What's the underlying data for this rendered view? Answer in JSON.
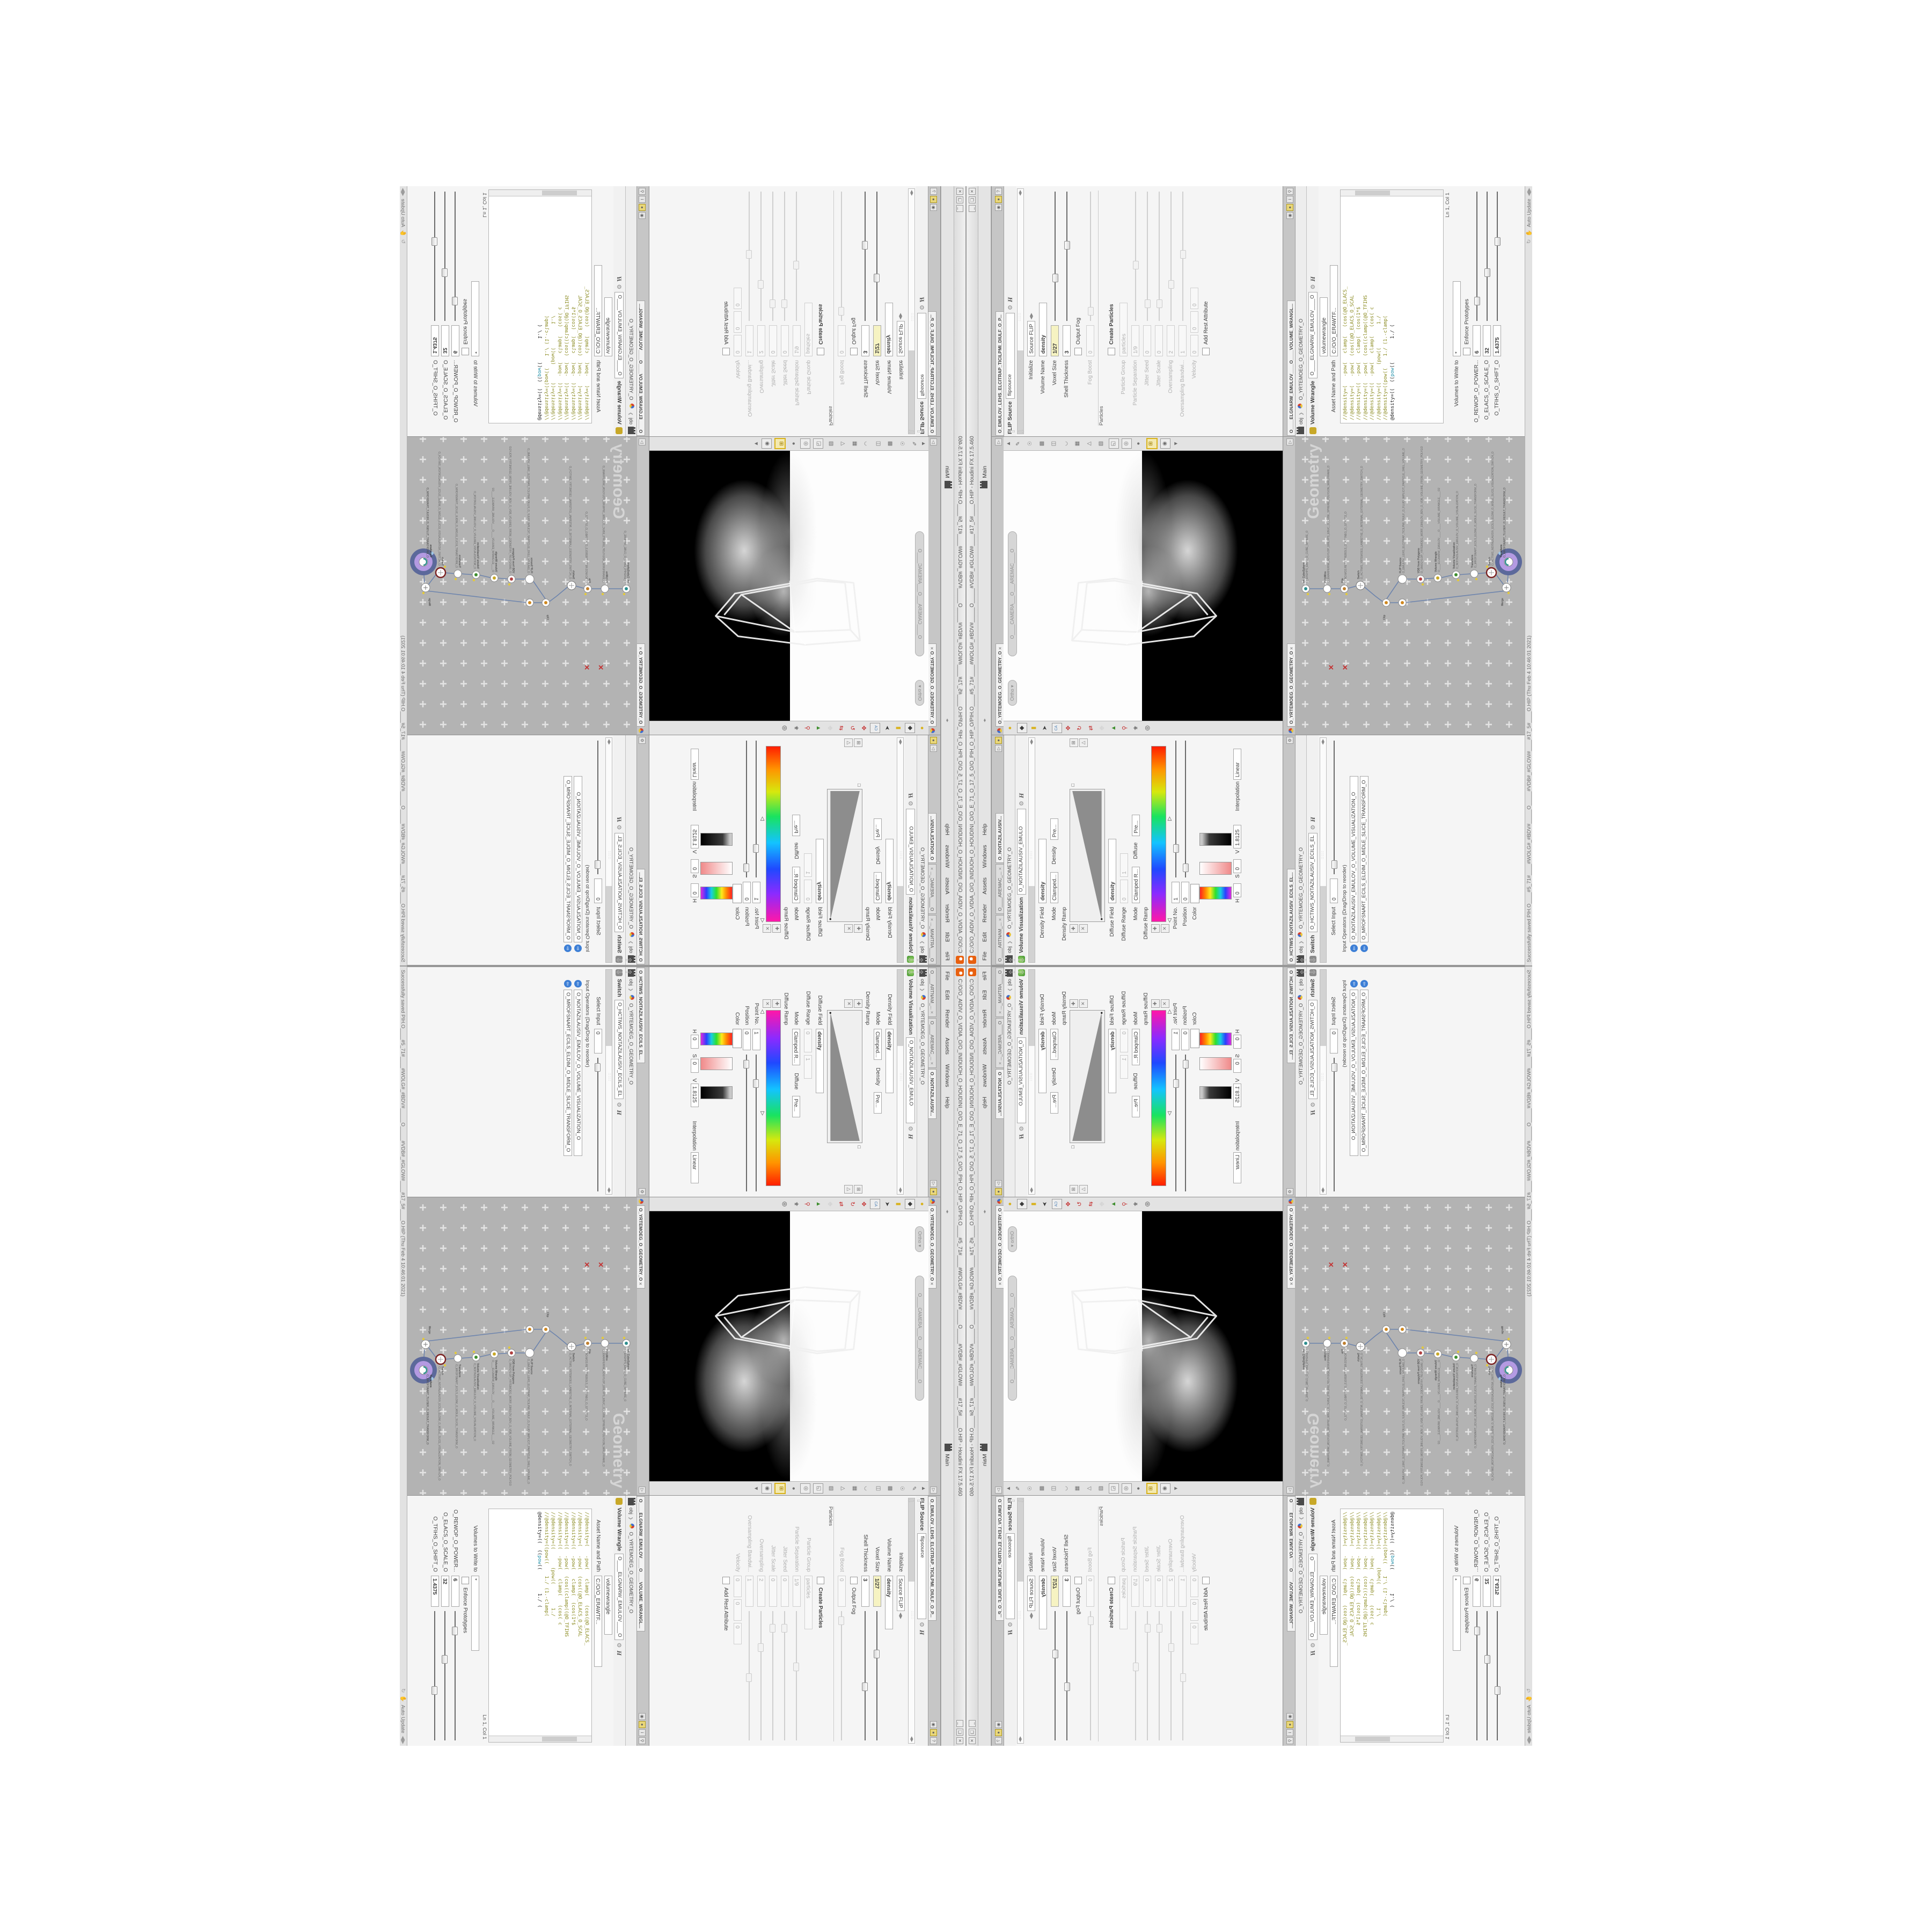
{
  "window": {
    "title": "C:/O/O_AIDIV_O_VIDIA_O/O_INIDUOH_O_HOUDINI_O/O_E_71_O_17_5_O/O_PIH_O_HIP_O/PIH.O____#5_71#____#WOLG#_#BDV#_____O_____#VDB#_#GLOW#____#17_5#____O.HIP - Houdini FX 17.5.460",
    "btn_min": "_",
    "btn_max": "❏",
    "btn_close": "✕"
  },
  "menu": {
    "items": [
      "File",
      "Edit",
      "Render",
      "Assets",
      "Windows",
      "Help"
    ],
    "desktop": "Main",
    "splitter": "◂▸"
  },
  "status": {
    "saved": "Successfully saved PIH.O____#5_71#____#WOLG#_#BDV#_____O_____#VDB#_#GLOW#____#17_5#____O.HIP  (Thu Feb 4 10:46:01 2021)",
    "auto_update": "Auto Update"
  },
  "crumb": {
    "net": "obj",
    "node": "O_YRTEMOEG_O_GEOMETRY_O"
  },
  "volviz": {
    "tab1": "O____ARTNAM_...",
    "tab2": "O____AREMAC_...",
    "tab3": "O_NOITAZILAUSIV...",
    "title": "Volume Visualization",
    "name": "O_NOITAZILAUSIV_EMULO",
    "density_field_label": "Density Field",
    "density_field": "density",
    "mode_label": "Mode",
    "mode": "Clamped...",
    "mode_tag": "Density",
    "presets": "Pre...",
    "density_ramp_label": "Density Ramp",
    "diffuse_field_label": "Diffuse Field",
    "diffuse_field": "density",
    "diffuse_range_label": "Diffuse Range",
    "range0": "0",
    "range1": "1",
    "mode2": "Clamped R...",
    "mode2_tag": "Diffuse",
    "diffuse_ramp_label": "Diffuse Ramp",
    "point_label": "Point No.",
    "point": "1",
    "pos_label": "Position",
    "pos": "0",
    "color_label": "Color",
    "h_label": "H",
    "h": "0",
    "s_label": "S",
    "s": "0",
    "v_label": "V",
    "v": "1.8125",
    "interp_label": "Interpolation",
    "interp": "Linear"
  },
  "viewport": {
    "tab": "O_YRTEMOEG_O_GEOMETRY_O",
    "ortho": "Ortho ▾",
    "camera": "O____CAMERA___O___AREMAC____O"
  },
  "flip": {
    "tab": "O_EMULOV_LEHS_ELCITRAP_TICILPMI_DIULF_O_P...",
    "title": "FLIP Source",
    "name": "flipsource",
    "rows": {
      "initialize_label": "Initialize",
      "initialize": "Source FLIP",
      "volname_label": "Volume Name",
      "volname": "density",
      "voxel_label": "Voxel Size",
      "voxel": "1/27",
      "shell_label": "Shell Thickness",
      "shell": "3",
      "outputfog_label": "Output Fog",
      "fogboost_label": "Fog Boost",
      "fogboost": "0",
      "particles_group": "Particles",
      "createpart_label": "Create Particles",
      "pgroup_label": "Particle Group",
      "pgroup": "particles",
      "psep_label": "Particle Separation",
      "psep": "1/9",
      "jseed_label": "Jitter Seed",
      "jseed": "0",
      "jscale_label": "Jitter Scale",
      "jscale": "0",
      "oversamp_label": "Oversampling",
      "oversamp": "2",
      "oband_label": "Oversampling Bandwi...",
      "oband": "1",
      "vel_label": "Velocity",
      "vel0": "0",
      "vel1": "0",
      "vel2": "0",
      "rest_label": "Add Rest Attribute"
    }
  },
  "switch": {
    "tab": "O_HCTIWS_NOITAZILAUSIV_ECILS_EL...",
    "title": "Switch",
    "name": "O_HCTIWS_NOITAZILAUSIV_ECILS_EL",
    "select_label": "Select Input",
    "select": "0",
    "ops_label": "Input Operators (Drag/Drop to reorder)",
    "op1": "O_NOITAZILAUSIV_EMULOV_O_VOLUME_VISUALIZATION_O",
    "op2": "O_MROFSNART_ECILS_ELDIM_O_MIDLE_SLICE_TRANSFORM_O"
  },
  "network": {
    "tab": "O_YRTEMOEG_O_GEOMETRY_O",
    "watermark": "Geometry",
    "nodes": [
      {
        "t": "an_CubeSphere",
        "n": "O_EREHPS_EBUC_O_CUBE_SPHERE_O"
      },
      {
        "t": "PolyWire",
        "n": "O_EMARFERIW_NOGYLOP_EREHPS_EBUC_O_CUBE_SPHERE_POLYGON_WIREFRAME_O"
      },
      {
        "t": "File",
        "n": "O_BO.MO3.RETS.TREBOLS_O_ASUNEG_O_GENUS3_O"
      },
      {
        "t": "Switch",
        "n": "O_HCTIWS_YRTEMOEG_LANRETXE_O_INTERNAL_EXTERNAL_GEOMETRY_SWITCH_O"
      },
      {
        "t": "Clip",
        "n": "O_EMULOV_PILC_O_CLIP_VOLUME_O"
      },
      {
        "t": "FLIP Source",
        "n": "O_EMULOV_LEHS_ELCITRAP_TICILPMI_DIULF_O_FLUID_IMPLICIT_PARTICLE_SHEL_VOLUME_O"
      },
      {
        "t": "VDB from Polygons",
        "n": "O_SNOGYLOP_YRTEMOEG_MORF_EMULOV_BDV_O_VDB_VOLUME_FROM_GEOMETRY_POLYGO"
      },
      {
        "t": "Volume Wrangle",
        "n": "O____ELGNARW_EMULOV____O____VOLUME_WRANGLE____O2"
      },
      {
        "t": "Volume Visualization",
        "n": "O_NOITAZILAUSIV_EMULOV_O_VOLUME_VISUALIZATION_O"
      },
      {
        "t": "Transform",
        "n": "O_MROFSNART_ECILS_ELDIM_O_MIDLE_SLICE_TRANSFORM_O"
      },
      {
        "t": "Switch",
        "n": "O_HCTIWS_NOITAZILAUSIV_ECILS_ELDIM_O_MIDLE_SLICE_VISUALIZATION_SWITCH_O"
      },
      {
        "t": "Merge",
        "n": "O_ECAFRUS_HTIW_EMULOV_EGREM_O_MERGE_VOLUME_WITH_SURFACE_O"
      },
      {
        "t": "Transform",
        "n": "O_MROFSNART_TLUSER_O_RESULT_TRANSFORM_O"
      }
    ],
    "redx": "✕"
  },
  "wrangle": {
    "tab": "O____ELGNARW_EMULOV____O____VOLUME_WRANGL...",
    "title": "Volume Wrangle",
    "name": "O____ELGNARW_EMULOV____O",
    "preset": "volumewrangle",
    "asset_label": "Asset Name and Path",
    "asset": "C:/O/O_ERAWTF...",
    "code": [
      "//@density=(   -pow(   clamp(   (cos(@O_ELACS_",
      "//@density=(   -pow(  (cos((@O_ELACS_O_SCAL",
      "//@density=((  -pow(   clamp(  (cos(1*$",
      "//@density=((  -pow(  (cos((clamp((@O_TFIHS",
      "//@density=((  -pow(   clamp(   (cos( c",
      "//@density=((      (pow((        1./",
      "//@density=((pow((    1./ (1.-clamp(",
      ""
    ],
    "l8a": "@density=((  ((",
    "l8kw": "pow",
    "l8b": "((        1./ (",
    "lncol": "Ln 1, Col 1",
    "volumes_label": "Volumes to Write to",
    "volumes": "*",
    "enforce_label": "Enforce Prototypes",
    "power_label": "O_REWOP_O_POWER...",
    "power": "6",
    "scale_label": "O_ELACS_O_SCALE_O",
    "scale": "32",
    "shift_label": "O_TFIHS_O_SHIFT_O",
    "shift": "1.4375"
  },
  "colors": {
    "accent_yellow_field": "#f6f3c2",
    "code_olive": "#8b8b21",
    "keyword_teal": "#1f8fa8",
    "network_bg": "#b3b3b3",
    "node_selected_inner": "#b49ae2",
    "node_selected_ring": "#5c699b",
    "houdini_orange": "#e8600f",
    "wire_blue": "#6d84ad",
    "flag_yellow": "#e3c93c",
    "error_red": "#c43030",
    "input_op_blue": "#3d7fd6"
  }
}
